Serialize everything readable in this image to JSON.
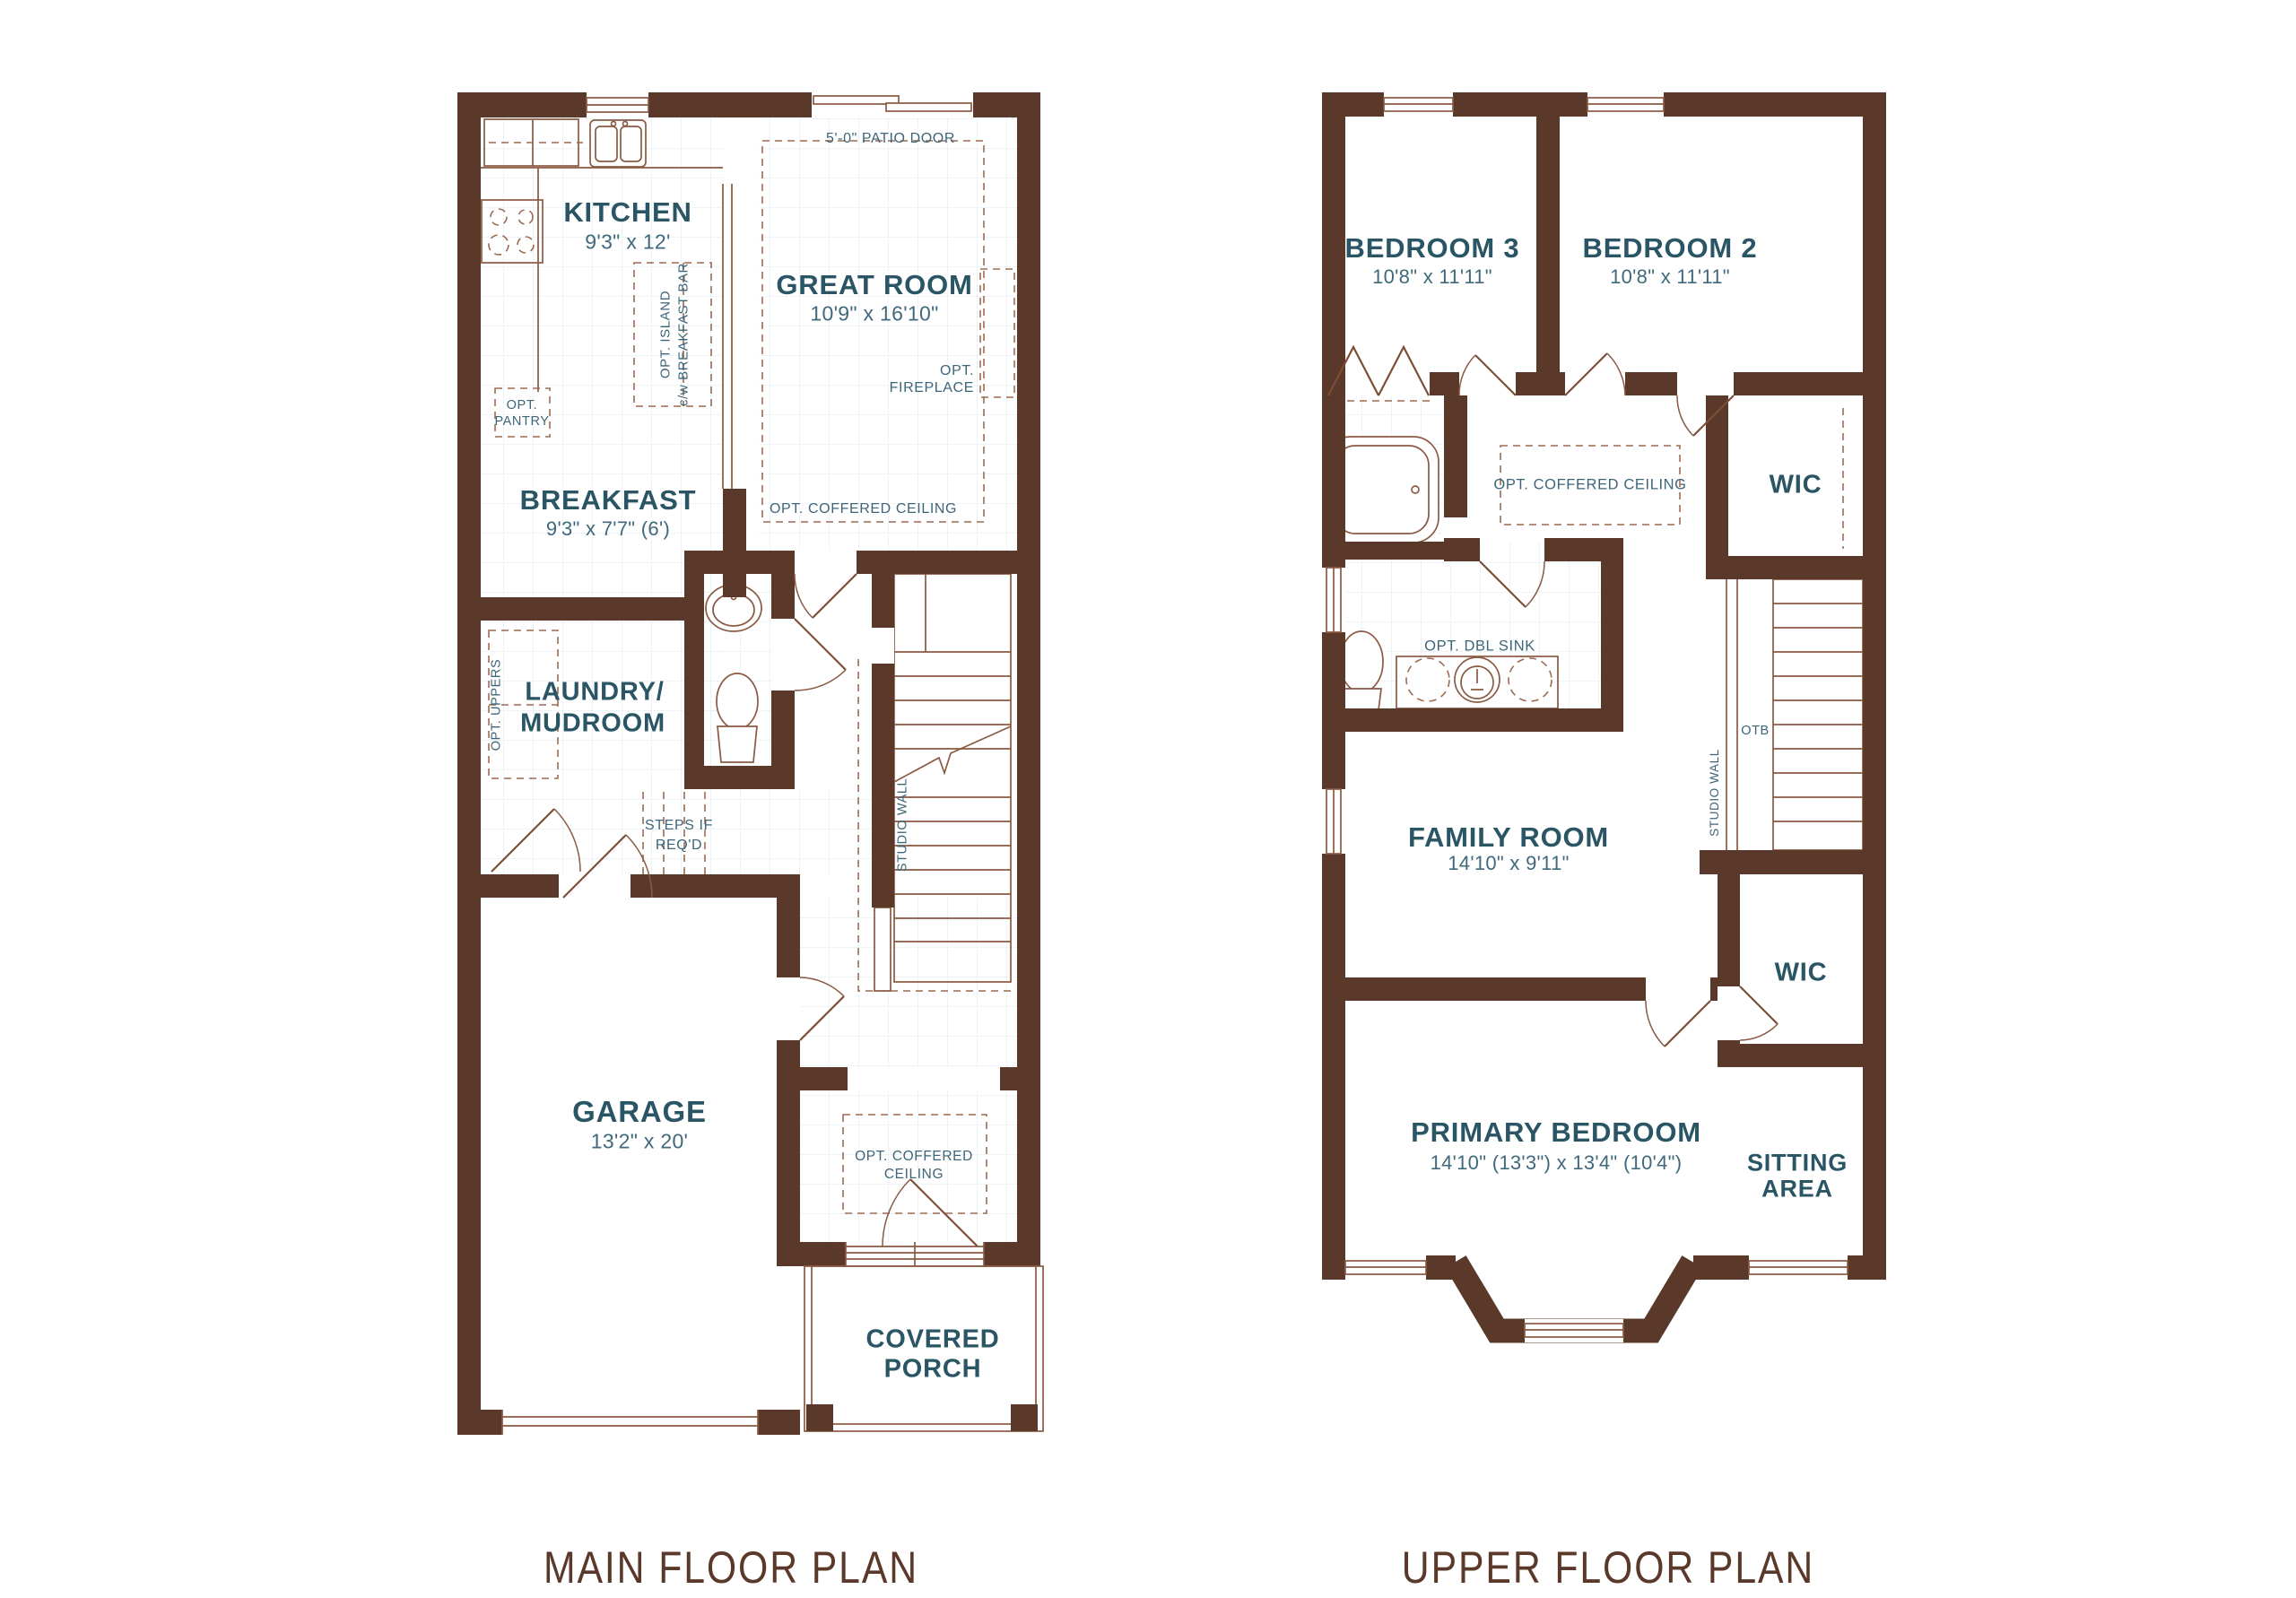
{
  "colors": {
    "wall": "#5b392a",
    "thin_line": "#8a5a43",
    "dashed_line": "#9c6b51",
    "room_label": "#2a5565",
    "dimension_text": "#40697c",
    "caption_text": "#5b392a",
    "tile_grid": "#e3edf2"
  },
  "main_floor": {
    "caption": "MAIN FLOOR PLAN",
    "rooms": {
      "kitchen": {
        "name": "KITCHEN",
        "dims": "9'3\" x 12'"
      },
      "great_room": {
        "name": "GREAT ROOM",
        "dims": "10'9\" x 16'10\""
      },
      "breakfast": {
        "name": "BREAKFAST",
        "dims": "9'3\" x 7'7\" (6')"
      },
      "laundry": {
        "line1": "LAUNDRY/",
        "line2": "MUDROOM"
      },
      "garage": {
        "name": "GARAGE",
        "dims": "13'2\" x 20'"
      },
      "covered_porch": {
        "line1": "COVERED",
        "line2": "PORCH"
      }
    },
    "annotations": {
      "patio_door": "5'-0\" PATIO DOOR",
      "opt_fireplace_1": "OPT.",
      "opt_fireplace_2": "FIREPLACE",
      "opt_coffered_great": "OPT. COFFERED CEILING",
      "opt_island_1": "OPT. ISLAND",
      "opt_island_2": "c/w BREAKFAST BAR",
      "opt_pantry_1": "OPT.",
      "opt_pantry_2": "PANTRY",
      "opt_uppers": "OPT. UPPERS",
      "steps_1": "STEPS IF",
      "steps_2": "REQ'D",
      "studio_wall": "STUDIO WALL",
      "opt_coffered_foyer_1": "OPT. COFFERED",
      "opt_coffered_foyer_2": "CEILING"
    }
  },
  "upper_floor": {
    "caption": "UPPER FLOOR PLAN",
    "rooms": {
      "bedroom3": {
        "name": "BEDROOM 3",
        "dims": "10'8\" x 11'11\""
      },
      "bedroom2": {
        "name": "BEDROOM 2",
        "dims": "10'8\" x 11'11\""
      },
      "wic_upper": "WIC",
      "family_room": {
        "name": "FAMILY ROOM",
        "dims": "14'10\" x 9'11\""
      },
      "wic_lower": "WIC",
      "primary": {
        "name": "PRIMARY BEDROOM",
        "dims": "14'10\" (13'3\") x 13'4\" (10'4\")"
      },
      "sitting": {
        "line1": "SITTING",
        "line2": "AREA"
      }
    },
    "annotations": {
      "opt_coffered": "OPT. COFFERED CEILING",
      "opt_dbl_sink": "OPT. DBL SINK",
      "otb": "OTB",
      "studio_wall": "STUDIO WALL"
    }
  }
}
